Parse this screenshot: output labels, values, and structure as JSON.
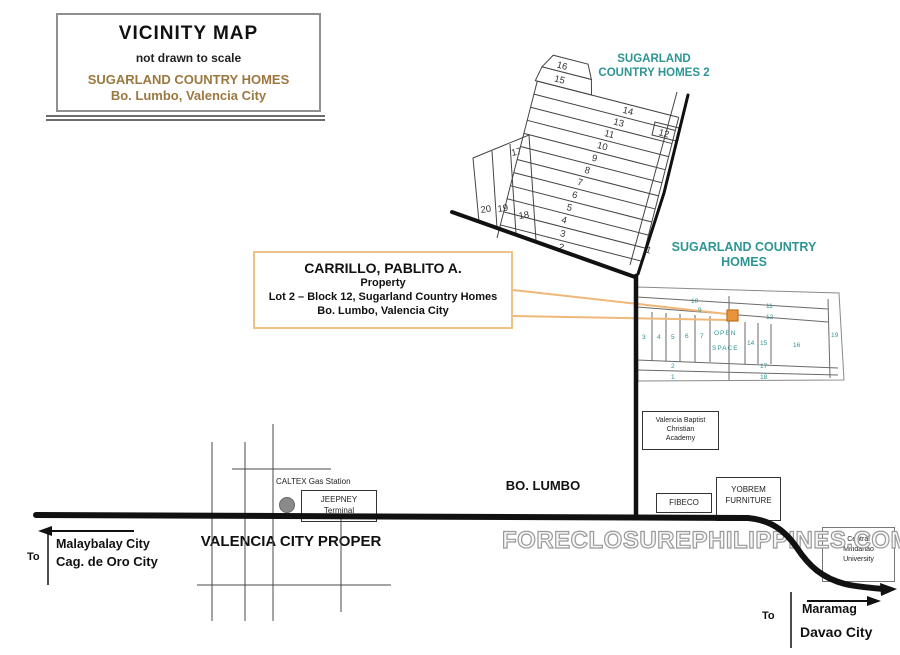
{
  "title_box": {
    "title": "VICINITY MAP",
    "subtitle": "not drawn to scale",
    "project": "SUGARLAND COUNTRY HOMES",
    "location": "Bo. Lumbo, Valencia City"
  },
  "callout": {
    "owner": "CARRILLO, PABLITO A.",
    "line2": "Property",
    "line3": "Lot 2 – Block 12, Sugarland Country Homes",
    "line4": "Bo. Lumbo, Valencia City"
  },
  "sub2": {
    "heading": [
      "SUGARLAND",
      "COUNTRY HOMES 2"
    ],
    "strips": [
      "2",
      "3",
      "4",
      "5",
      "6",
      "7",
      "8",
      "9",
      "10",
      "11",
      "13",
      "14"
    ],
    "tip": [
      "15",
      "16"
    ],
    "left_col": [
      "20",
      "19",
      "18"
    ],
    "lot17": "17",
    "lot12": "12",
    "lot1": "1"
  },
  "sub1": {
    "heading": [
      "SUGARLAND COUNTRY",
      "HOMES"
    ],
    "top_left": [
      "10",
      "9"
    ],
    "top_right": [
      "11",
      "12"
    ],
    "mid": [
      "3",
      "4",
      "5",
      "6",
      "7"
    ],
    "open_space": [
      "OPEN",
      "SPACE"
    ],
    "right": [
      "14",
      "15",
      "16"
    ],
    "lot19": "19",
    "bottom_left": [
      "2",
      "1"
    ],
    "bottom_right": [
      "17",
      "18"
    ]
  },
  "roads": {
    "valencia_city_proper": "VALENCIA CITY PROPER",
    "bo_lumbo": "BO. LUMBO"
  },
  "directions": {
    "left": {
      "to": "To",
      "line1": "Malaybalay City",
      "line2": "Cag. de Oro City"
    },
    "right": {
      "to": "To",
      "line1": "Maramag",
      "line2": "Davao City"
    }
  },
  "landmarks": {
    "caltex": "CALTEX Gas Station",
    "jeepney": [
      "JEEPNEY",
      "Terminal"
    ],
    "vbca": [
      "Valencia Baptist",
      "Christian",
      "Academy"
    ],
    "fibeco": "FIBECO",
    "yobrem": [
      "YOBREM",
      "FURNITURE"
    ],
    "cmu": [
      "Central",
      "Mindanao",
      "University"
    ]
  },
  "watermark": "FORECLOSUREPHILIPPINES.COM",
  "colors": {
    "teal": "#2e9494",
    "brown": "#9c7840",
    "highlight_orange": "#e8943c",
    "callout_border": "#efc187",
    "road_black": "#111111"
  }
}
